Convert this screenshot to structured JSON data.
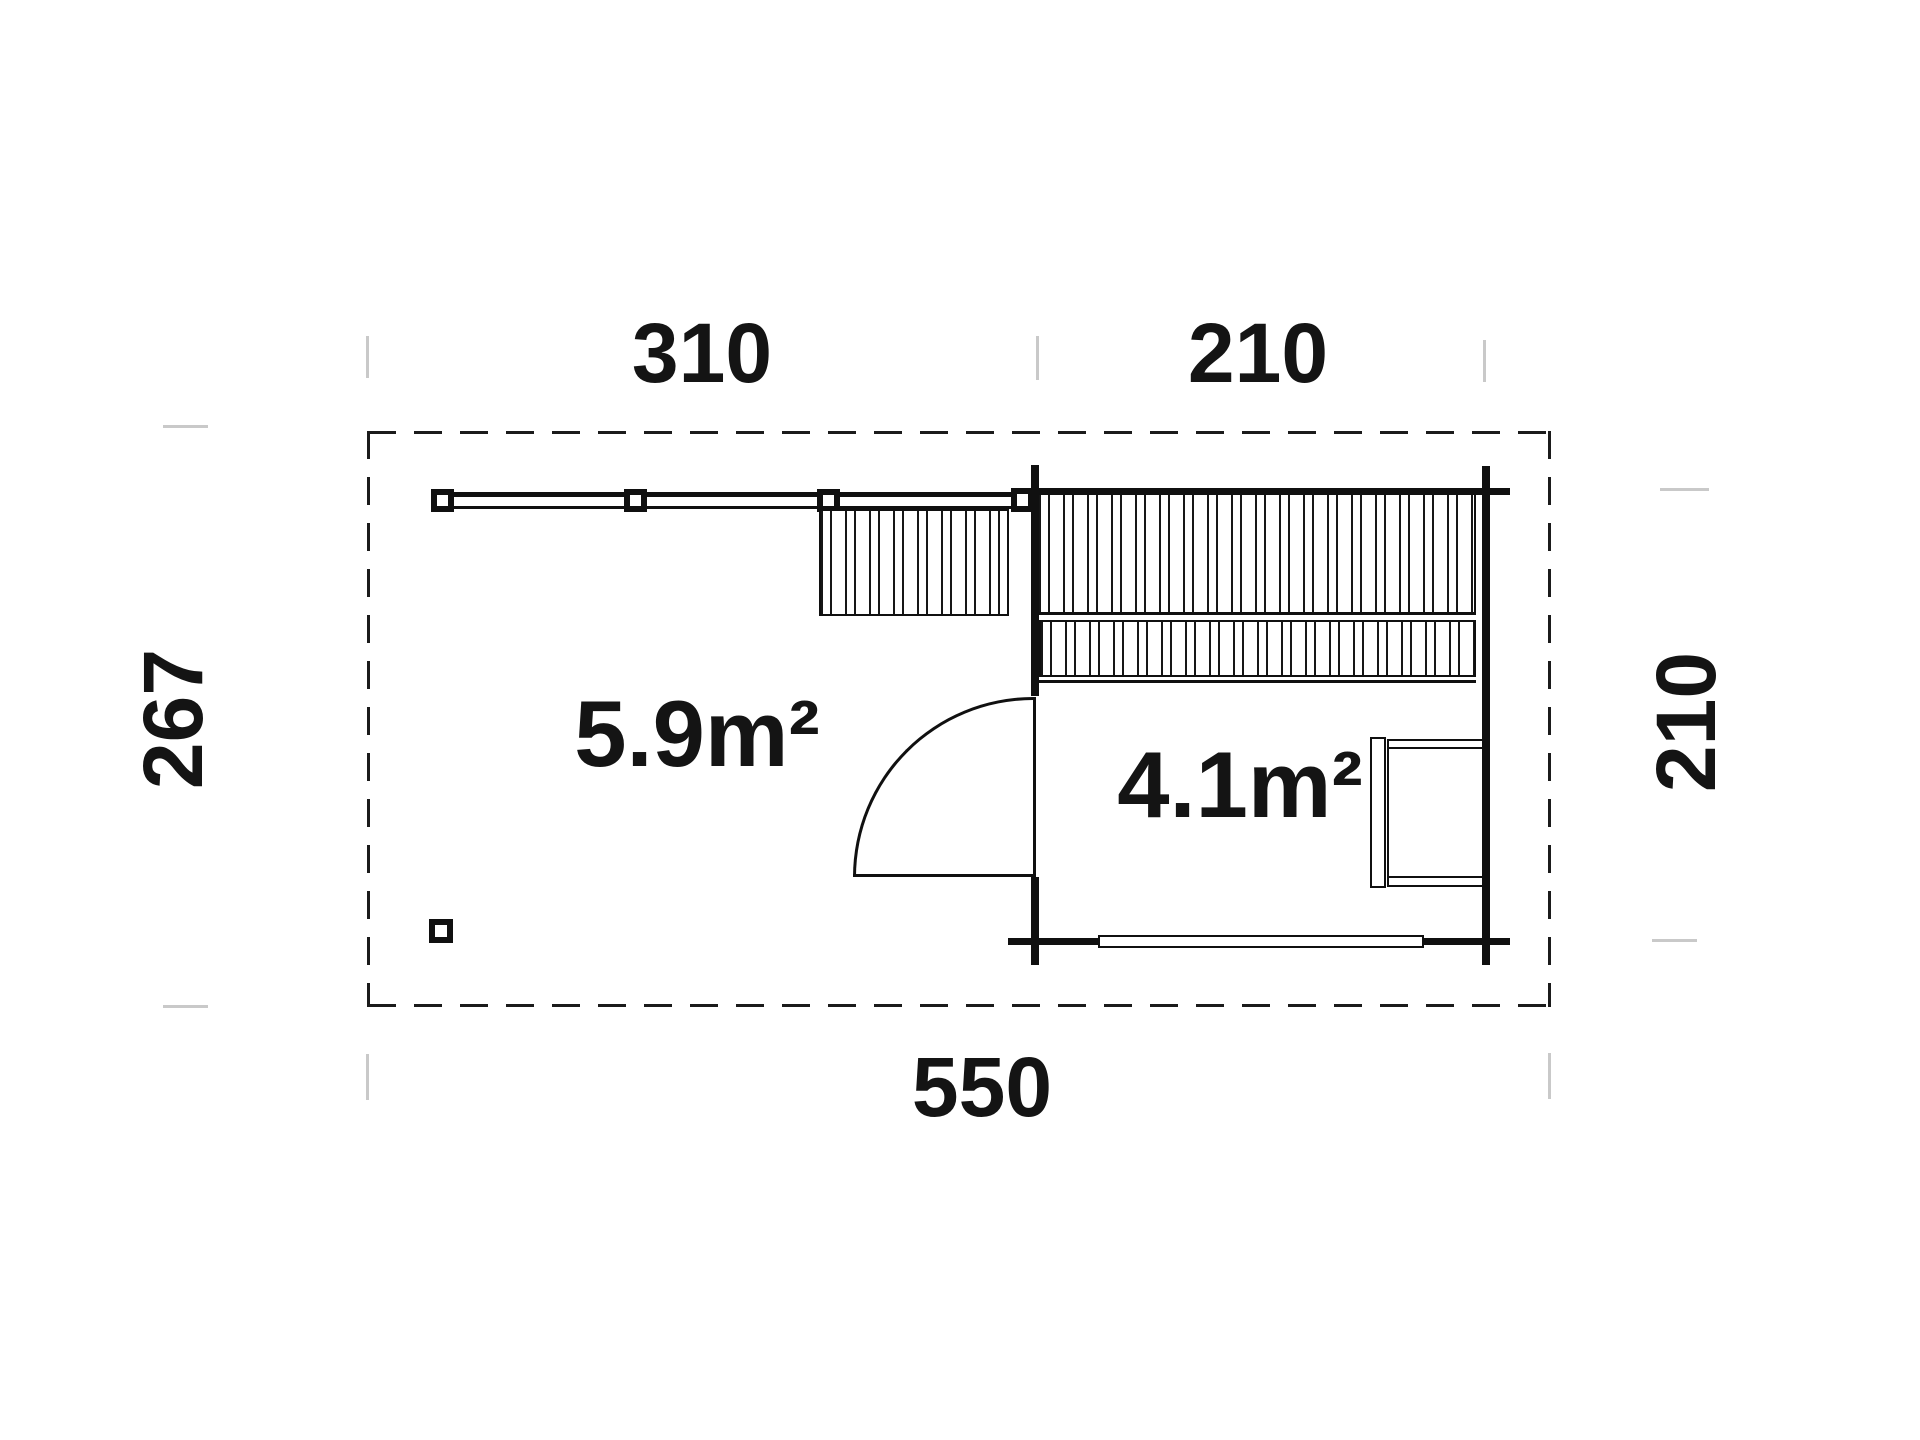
{
  "document": {
    "type": "floor-plan",
    "units": "cm",
    "background_color": "#ffffff",
    "line_color": "#101010",
    "extension_tick_color": "#c9c9c9",
    "text_color": "#141414"
  },
  "dimensions": {
    "top_left_width": "310",
    "top_right_width": "210",
    "left_height": "267",
    "right_height": "210",
    "bottom_total_width": "550"
  },
  "areas": {
    "terrace": "5.9m²",
    "room": "4.1m²"
  }
}
